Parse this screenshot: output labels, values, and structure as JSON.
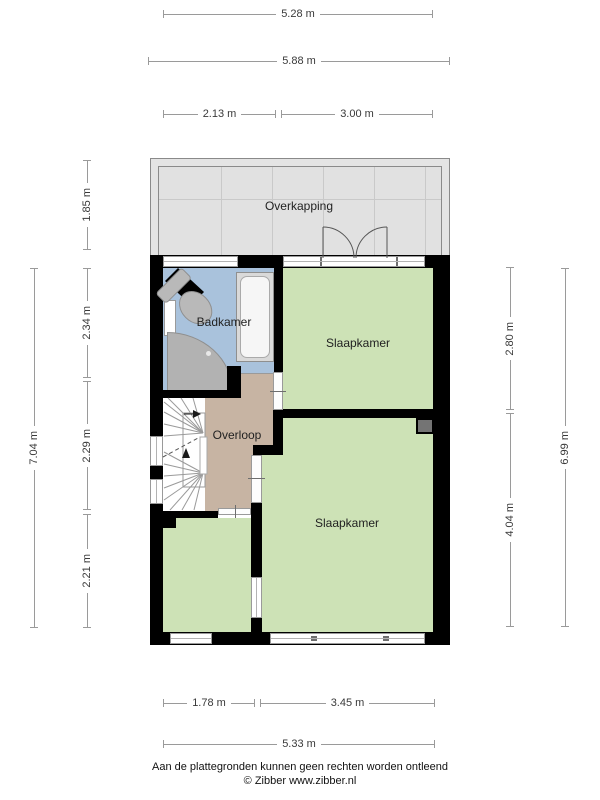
{
  "rooms": {
    "overkapping": "Overkapping",
    "badkamer": "Badkamer",
    "slaapkamer_top": "Slaapkamer",
    "overloop": "Overloop",
    "slaapkamer_bottom": "Slaapkamer"
  },
  "dimensions": {
    "top_inner": "5.28 m",
    "top_outer": "5.88 m",
    "top_seg_left": "2.13 m",
    "top_seg_right": "3.00 m",
    "left_overkapping": "1.85 m",
    "left_total": "7.04 m",
    "left_seg_badkamer": "2.34 m",
    "left_seg_overloop": "2.29 m",
    "left_seg_kamer": "2.21 m",
    "right_seg_top": "2.80 m",
    "right_total": "6.99 m",
    "right_seg_bottom": "4.04 m",
    "bottom_seg_left": "1.78 m",
    "bottom_seg_right": "3.45 m",
    "bottom_total": "5.33 m"
  },
  "footer": {
    "disclaimer": "Aan de plattegronden kunnen geen rechten worden ontleend",
    "credit": "© Zibber www.zibber.nl"
  },
  "colors": {
    "room_green": "#cde2b6",
    "bathroom_blue": "#a9c2dc",
    "hall_tan": "#c7b4a3",
    "canopy_gray": "#e4e4e4",
    "wall_black": "#000000",
    "fixture_gray": "#b5b5b5"
  }
}
